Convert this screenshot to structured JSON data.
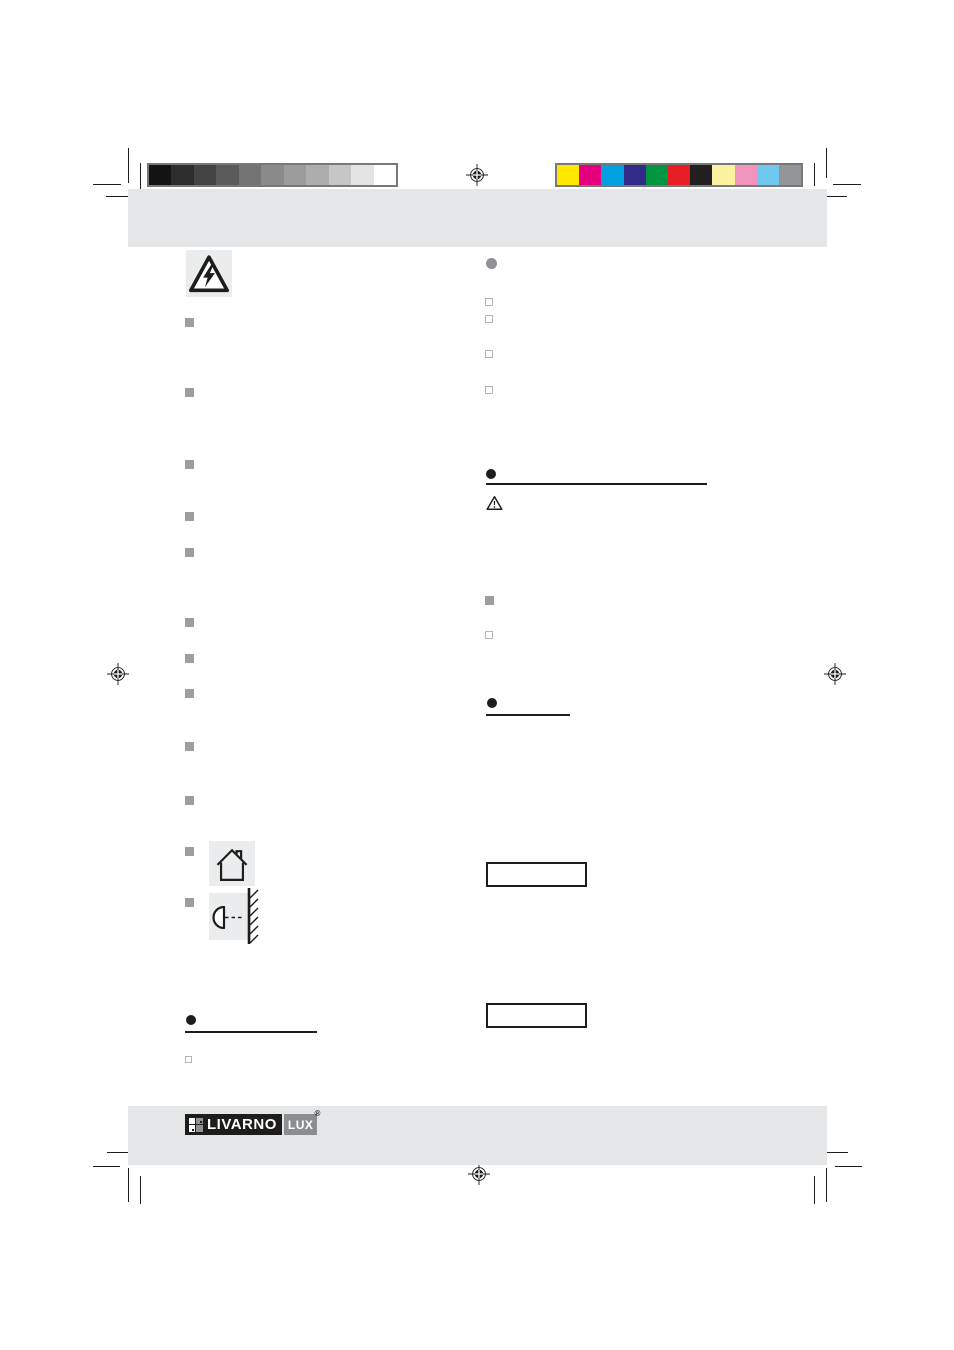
{
  "document": {
    "kind": "print-proof page of an instruction manual (text layer not rendered)",
    "page_bg": "#ffffff"
  },
  "logo": {
    "brand": "LIVARNO",
    "sub": "LUX",
    "registered": "®",
    "black": "#1d1d1b",
    "gray": "#8b8e90"
  },
  "colors": {
    "band_gray": "#e5e6e8",
    "icon_tile_gray": "#ebecee",
    "mark_black": "#1d1d1b",
    "bullet_gray": "#9b9da1",
    "outline_square_border": "#b3b5b9",
    "calibration_border": "#77787a"
  },
  "calibration": {
    "grayscale_bar": [
      "#131313",
      "#2d2d2d",
      "#434343",
      "#5b5b5b",
      "#747474",
      "#8a8a8a",
      "#9c9c9c",
      "#aeaeae",
      "#c6c6c6",
      "#e4e4e4",
      "#ffffff"
    ],
    "color_bar": [
      "#ffe800",
      "#e6007e",
      "#00a0e1",
      "#312a86",
      "#00963f",
      "#e51d25",
      "#231f20",
      "#fdf2a2",
      "#f094bd",
      "#70c8f0",
      "#929497"
    ]
  },
  "icons": {
    "high_voltage": "warning-triangle-lightning",
    "indoor_use": "house-outline",
    "wall_mount": "wall-lamp-with-hatched-wall",
    "caution": "warning-triangle-exclamation",
    "registration": "registration-target-mark"
  }
}
